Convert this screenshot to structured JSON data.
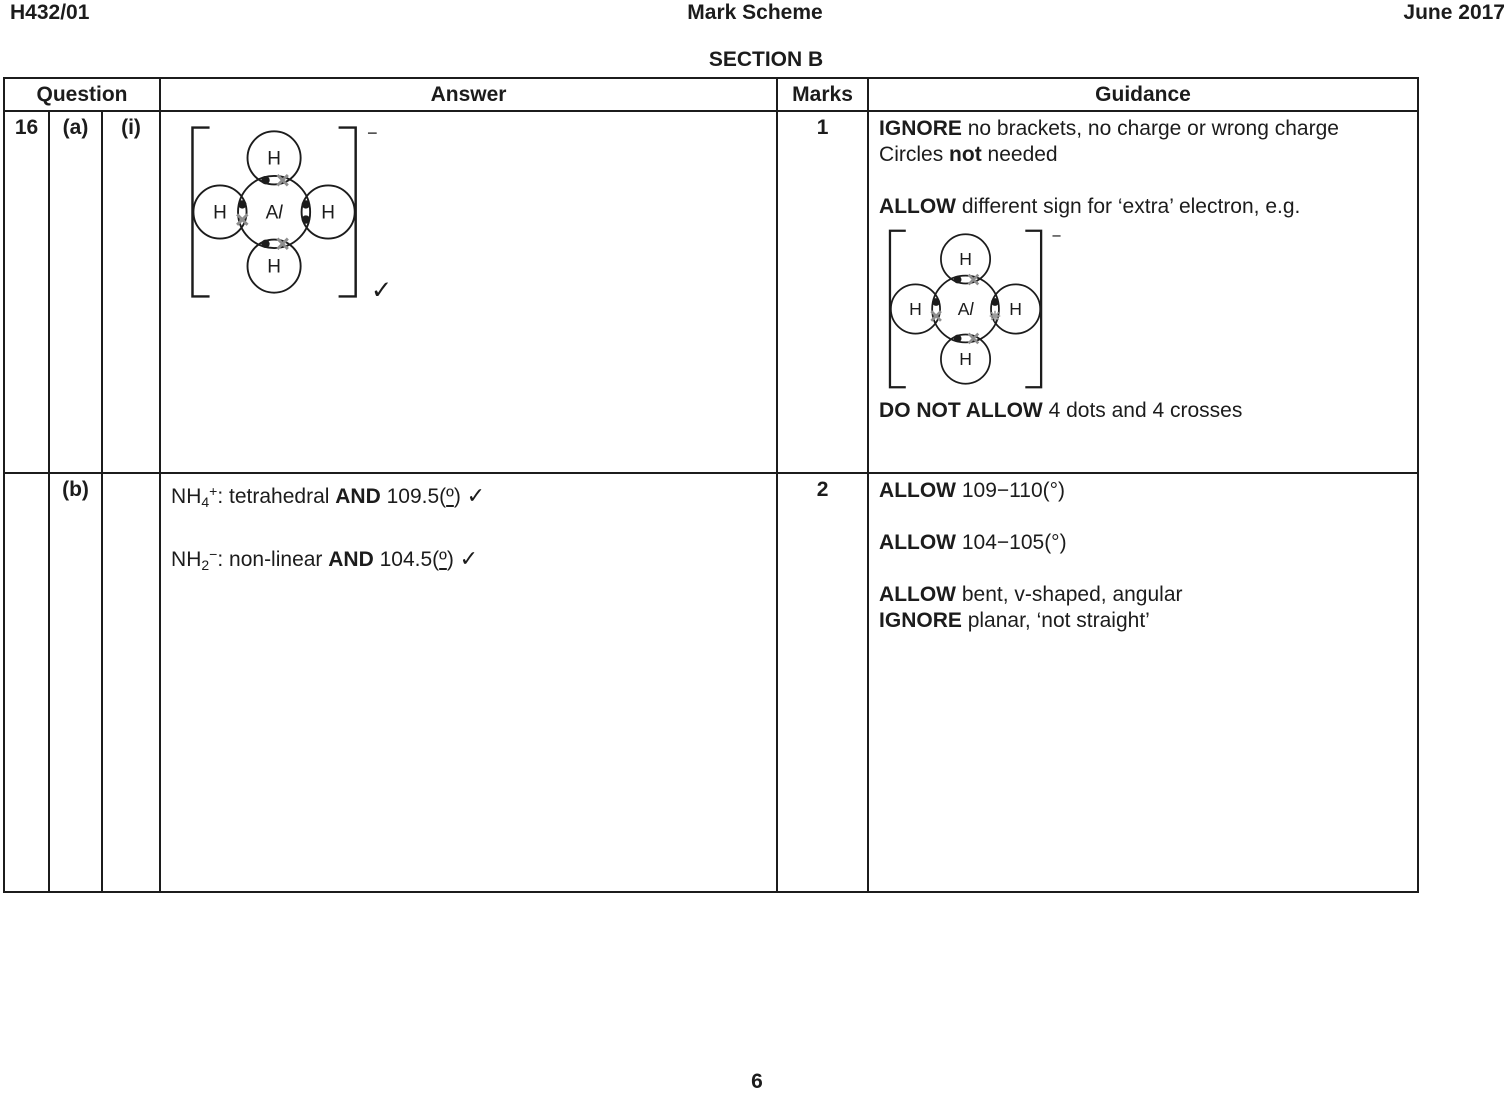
{
  "page": {
    "doc_code": "H432/01",
    "title": "Mark Scheme",
    "date": "June 2017",
    "section": "SECTION B",
    "page_number": "6"
  },
  "colors": {
    "ink": "#1c1c1c",
    "dot": "#1c1c1c",
    "cross": "#8e8e8e",
    "asterisk": "#9c9c9c"
  },
  "table": {
    "headers": {
      "question": "Question",
      "answer": "Answer",
      "marks": "Marks",
      "guidance": "Guidance"
    }
  },
  "row_a": {
    "number": "16",
    "part": "(a)",
    "sub": "(i)",
    "marks": "1",
    "answer_diagram": {
      "center_a": "A",
      "center_l": "l",
      "outer": "H",
      "charge": "−",
      "electrons": {
        "top": [
          "dot",
          "cross"
        ],
        "left": [
          "dot",
          "cross"
        ],
        "right": [
          "dot",
          "dot"
        ],
        "bottom": [
          "dot",
          "cross"
        ]
      },
      "tick": "✓"
    },
    "guidance_before": [
      [
        {
          "t": "IGNORE",
          "s": "b"
        },
        {
          "t": " no brackets, no charge or wrong charge"
        }
      ],
      [
        {
          "t": "Circles "
        },
        {
          "t": "not",
          "s": "b"
        },
        {
          "t": " needed"
        }
      ],
      [],
      [
        {
          "t": "ALLOW",
          "s": "b"
        },
        {
          "t": " different sign for ‘extra’ electron, e.g."
        }
      ]
    ],
    "guidance_diagram": {
      "center_a": "A",
      "center_l": "l",
      "outer": "H",
      "charge": "−",
      "electrons": {
        "top": [
          "dot",
          "cross"
        ],
        "left": [
          "dot",
          "cross"
        ],
        "right": [
          "dot",
          "asterisk"
        ],
        "bottom": [
          "dot",
          "cross"
        ]
      },
      "tick": ""
    },
    "guidance_after": [
      [
        {
          "t": "DO NOT ALLOW",
          "s": "b"
        },
        {
          "t": " 4 dots and 4 crosses"
        }
      ]
    ]
  },
  "row_b": {
    "part": "(b)",
    "marks": "2",
    "answer_lines": [
      [
        {
          "t": "NH"
        },
        {
          "t": "4",
          "s": "sub"
        },
        {
          "t": "+",
          "s": "sup"
        },
        {
          "t": ": tetrahedral "
        },
        {
          "t": "AND",
          "s": "b"
        },
        {
          "t": " 109.5("
        },
        {
          "t": "º",
          "s": "ord"
        },
        {
          "t": ") "
        },
        {
          "t": "✓",
          "s": "check"
        }
      ],
      [],
      [
        {
          "t": "NH"
        },
        {
          "t": "2",
          "s": "sub"
        },
        {
          "t": "−",
          "s": "sup"
        },
        {
          "t": ": non-linear "
        },
        {
          "t": "AND",
          "s": "b"
        },
        {
          "t": " 104.5("
        },
        {
          "t": "º",
          "s": "ord"
        },
        {
          "t": ") "
        },
        {
          "t": "✓",
          "s": "check"
        }
      ]
    ],
    "guidance_lines": [
      [
        {
          "t": "ALLOW",
          "s": "b"
        },
        {
          "t": " 109−110(°)"
        }
      ],
      [],
      [
        {
          "t": "ALLOW",
          "s": "b"
        },
        {
          "t": " 104−105(°)"
        }
      ],
      [],
      [
        {
          "t": "ALLOW",
          "s": "b"
        },
        {
          "t": " bent, v-shaped, angular"
        }
      ],
      [
        {
          "t": "IGNORE",
          "s": "b"
        },
        {
          "t": " planar, ‘not straight’"
        }
      ]
    ]
  }
}
